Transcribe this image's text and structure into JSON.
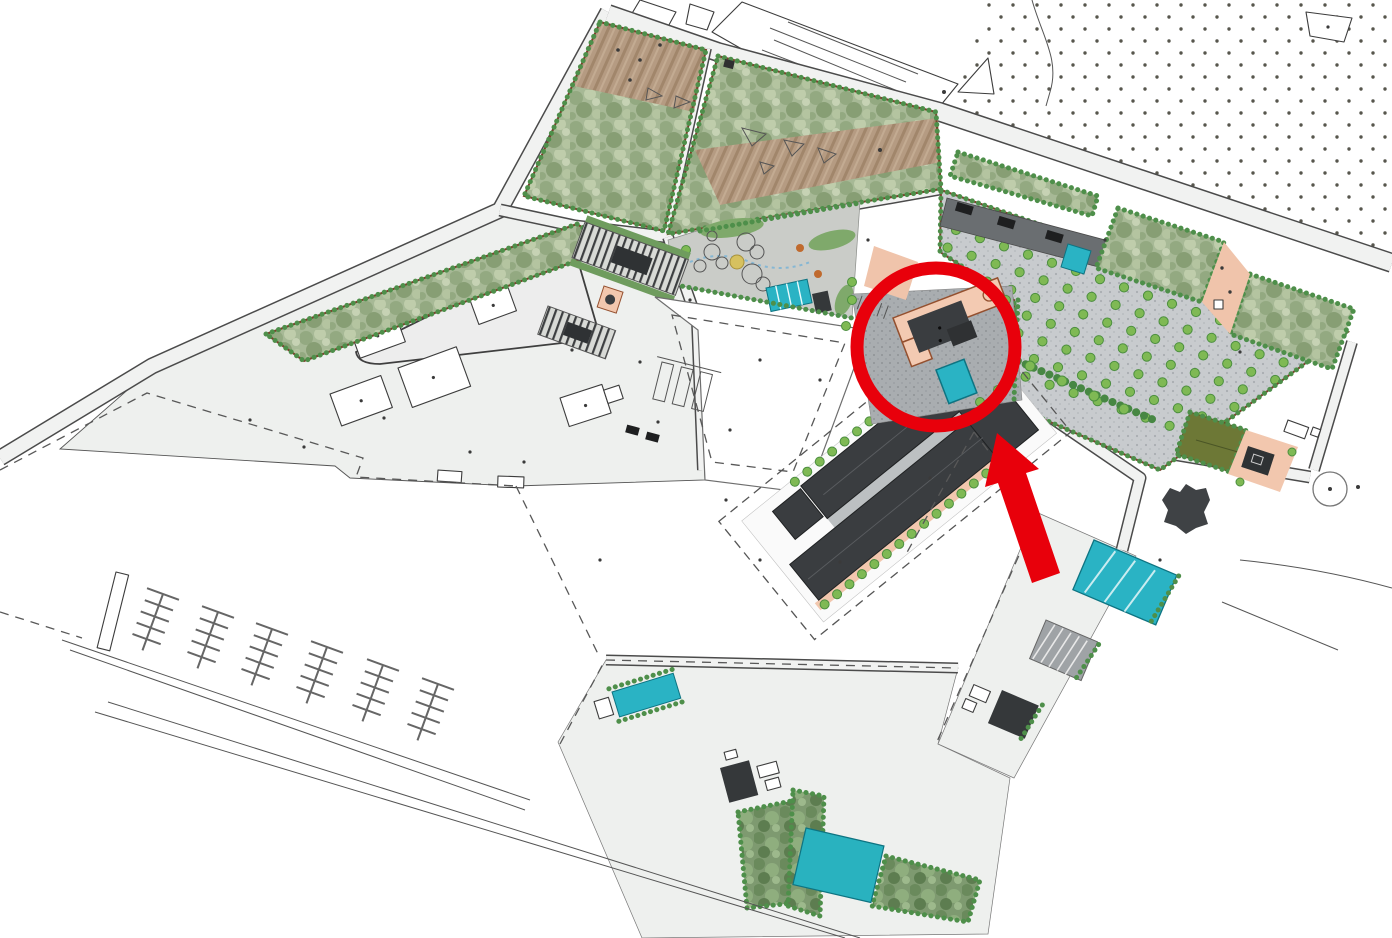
{
  "meta": {
    "title": "Landscape masterplan site drawing with red highlight annotations",
    "description": "Top-down colored site/master plan of a waterfront redevelopment: garden parcels, orchard parking rows, a dark roofed building complex, pools, a marina with finger docks, and a red circle plus red arrow highlighting a small pink-roofed building cluster on a paved plaza.",
    "image_width": 1392,
    "image_height": 938,
    "visible_text": []
  },
  "annotation": {
    "highlight_circle": {
      "cx": 936,
      "cy": 347,
      "r": 79,
      "stroke_width": 13,
      "color": "#e8000b"
    },
    "arrow": {
      "tip_x": 997,
      "tip_y": 433,
      "tail_x": 1046,
      "tail_y": 578,
      "color": "#e8000b"
    },
    "meaning": "red circle and arrow point to the pink building on the central plaza"
  },
  "palette": {
    "annotation_red": "#e8000b",
    "road_fill": "#f1f2f1",
    "road_edge": "#4b4b4b",
    "parcel_border_brown": "#7a402c",
    "vegetation_green_base": "#a7b996",
    "shrub_green_dark": "#7e9a70",
    "hedge_dot_green": "#4e8f4a",
    "tree_green": "#7fb954",
    "soil_brown": "#b59b82",
    "gravel_grey": "#c8cbce",
    "paver_grey": "#a9adb0",
    "asphalt_grey": "#6a6e71",
    "building_dark": "#3a3d40",
    "building_pink": "#f3cab2",
    "water_teal": "#2ab3c4",
    "olive_field": "#6d7836",
    "stipple_dot": "#57564d"
  },
  "areas": [
    {
      "name": "existing-orchard-stipple-field",
      "fill": "dot grid on white",
      "position": "top right"
    },
    {
      "name": "garden-parcel-1",
      "fill": "green mottle + brown soil",
      "position": "top left"
    },
    {
      "name": "garden-parcel-2",
      "fill": "green mottle + striped soil band with boulders",
      "position": "top centre"
    },
    {
      "name": "long-garden-parcel",
      "fill": "green mottle",
      "position": "left"
    },
    {
      "name": "orchard-parking-field",
      "fill": "gravel with tree rows",
      "position": "right"
    },
    {
      "name": "hedge-parcels",
      "fill": "green mottle",
      "position": "right of orchard"
    },
    {
      "name": "playground-garden",
      "fill": "grey with play circles, yellow circle, teal canopies",
      "position": "centre"
    },
    {
      "name": "left-urban-block",
      "fill": "light grey with outlined buildings",
      "position": "left centre"
    },
    {
      "name": "demolished-building-outline",
      "fill": "white, dashed outline",
      "position": "centre"
    },
    {
      "name": "dark-building-complex",
      "fill": "dark grey roofs in dashed parcel",
      "position": "centre"
    },
    {
      "name": "highlighted-pink-building-plaza",
      "fill": "pavers, pink L-building, teal pond",
      "position": "centre, circled in red"
    },
    {
      "name": "marina-finger-docks",
      "fill": "line art",
      "position": "bottom left"
    },
    {
      "name": "pools-and-shrubs",
      "fill": "teal pools, dark shrub beds",
      "position": "bottom centre and right"
    },
    {
      "name": "roundabout",
      "fill": "outline circle",
      "position": "bottom right"
    }
  ],
  "generated": {
    "orchard_grid": {
      "origin": [
        956,
        230
      ],
      "col_step": [
        24,
        8.2
      ],
      "row_step": [
        -8.4,
        17.6
      ],
      "cols": 17,
      "rows": 7,
      "radius": 4.6
    },
    "complex_tree_rows": [
      {
        "from": [
          56,
          -9
        ],
        "step": 16,
        "count": 13
      },
      {
        "from": [
          2,
          105
        ],
        "step": 16,
        "count": 15
      }
    ],
    "marina_docks": {
      "heads": [
        [
          163,
          594
        ],
        [
          218,
          612
        ],
        [
          272,
          629
        ],
        [
          327,
          647
        ],
        [
          383,
          665
        ],
        [
          438,
          684
        ]
      ],
      "angle_deg": 20,
      "stem_len": 60,
      "finger_pairs": 4,
      "finger_len": 15,
      "head_half": 17,
      "finger_spacing": 12
    },
    "ambient_dots": [
      [
        250,
        420
      ],
      [
        304,
        447
      ],
      [
        384,
        418
      ],
      [
        470,
        452
      ],
      [
        524,
        462
      ],
      [
        572,
        350
      ],
      [
        640,
        362
      ],
      [
        658,
        422
      ],
      [
        690,
        300
      ],
      [
        726,
        500
      ],
      [
        840,
        562
      ],
      [
        600,
        560
      ],
      [
        930,
        478
      ],
      [
        868,
        240
      ],
      [
        1105,
        240
      ],
      [
        1240,
        352
      ],
      [
        760,
        560
      ],
      [
        1160,
        560
      ]
    ]
  }
}
